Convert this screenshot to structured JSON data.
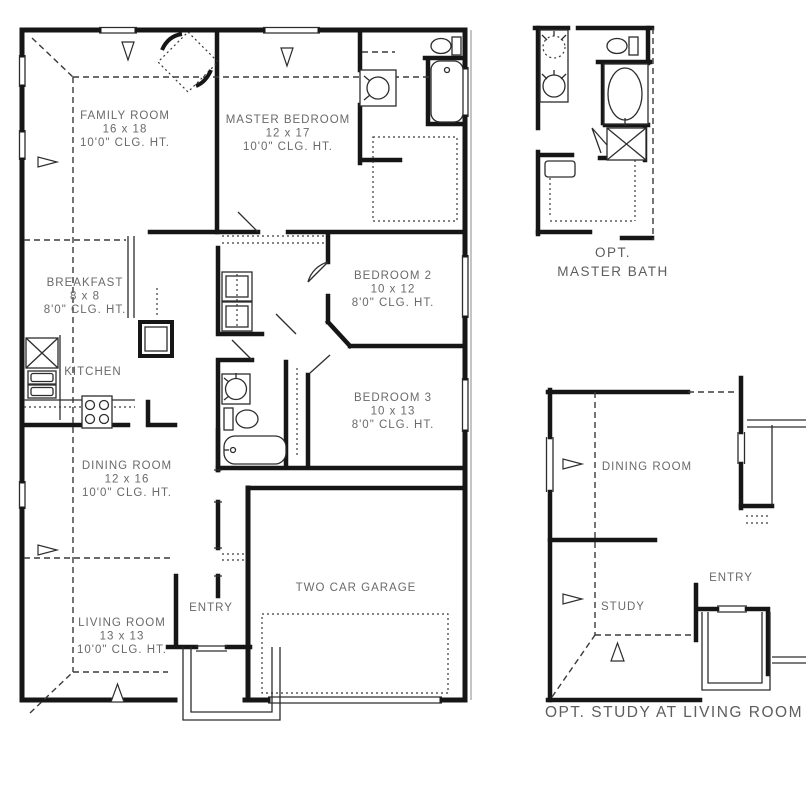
{
  "plan": {
    "rooms": [
      {
        "id": "family",
        "name": "FAMILY ROOM",
        "size": "16 x 18",
        "ceiling": "10'0\" CLG. HT."
      },
      {
        "id": "master",
        "name": "MASTER BEDROOM",
        "size": "12 x 17",
        "ceiling": "10'0\" CLG. HT."
      },
      {
        "id": "breakfast",
        "name": "BREAKFAST",
        "size": "8 x 8",
        "ceiling": "8'0\" CLG. HT."
      },
      {
        "id": "bedroom2",
        "name": "BEDROOM 2",
        "size": "10 x 12",
        "ceiling": "8'0\" CLG. HT."
      },
      {
        "id": "bedroom3",
        "name": "BEDROOM 3",
        "size": "10 x 13",
        "ceiling": "8'0\" CLG. HT."
      },
      {
        "id": "dining",
        "name": "DINING ROOM",
        "size": "12 x 16",
        "ceiling": "10'0\" CLG. HT."
      },
      {
        "id": "living",
        "name": "LIVING ROOM",
        "size": "13 x 13",
        "ceiling": "10'0\" CLG. HT."
      }
    ],
    "labels": {
      "kitchen": "KITCHEN",
      "entry": "ENTRY",
      "garage": "TWO CAR GARAGE"
    }
  },
  "inset_master_bath": {
    "caption_line1": "OPT.",
    "caption_line2": "MASTER BATH"
  },
  "inset_study": {
    "dining": "DINING ROOM",
    "study": "STUDY",
    "entry": "ENTRY",
    "caption": "OPT. STUDY AT LIVING ROOM"
  },
  "colors": {
    "wall": "#161616",
    "thin_line": "#2d2d2d",
    "dashed_line": "#3a3a3a",
    "label_text": "#6a6a6a",
    "background": "#ffffff"
  }
}
